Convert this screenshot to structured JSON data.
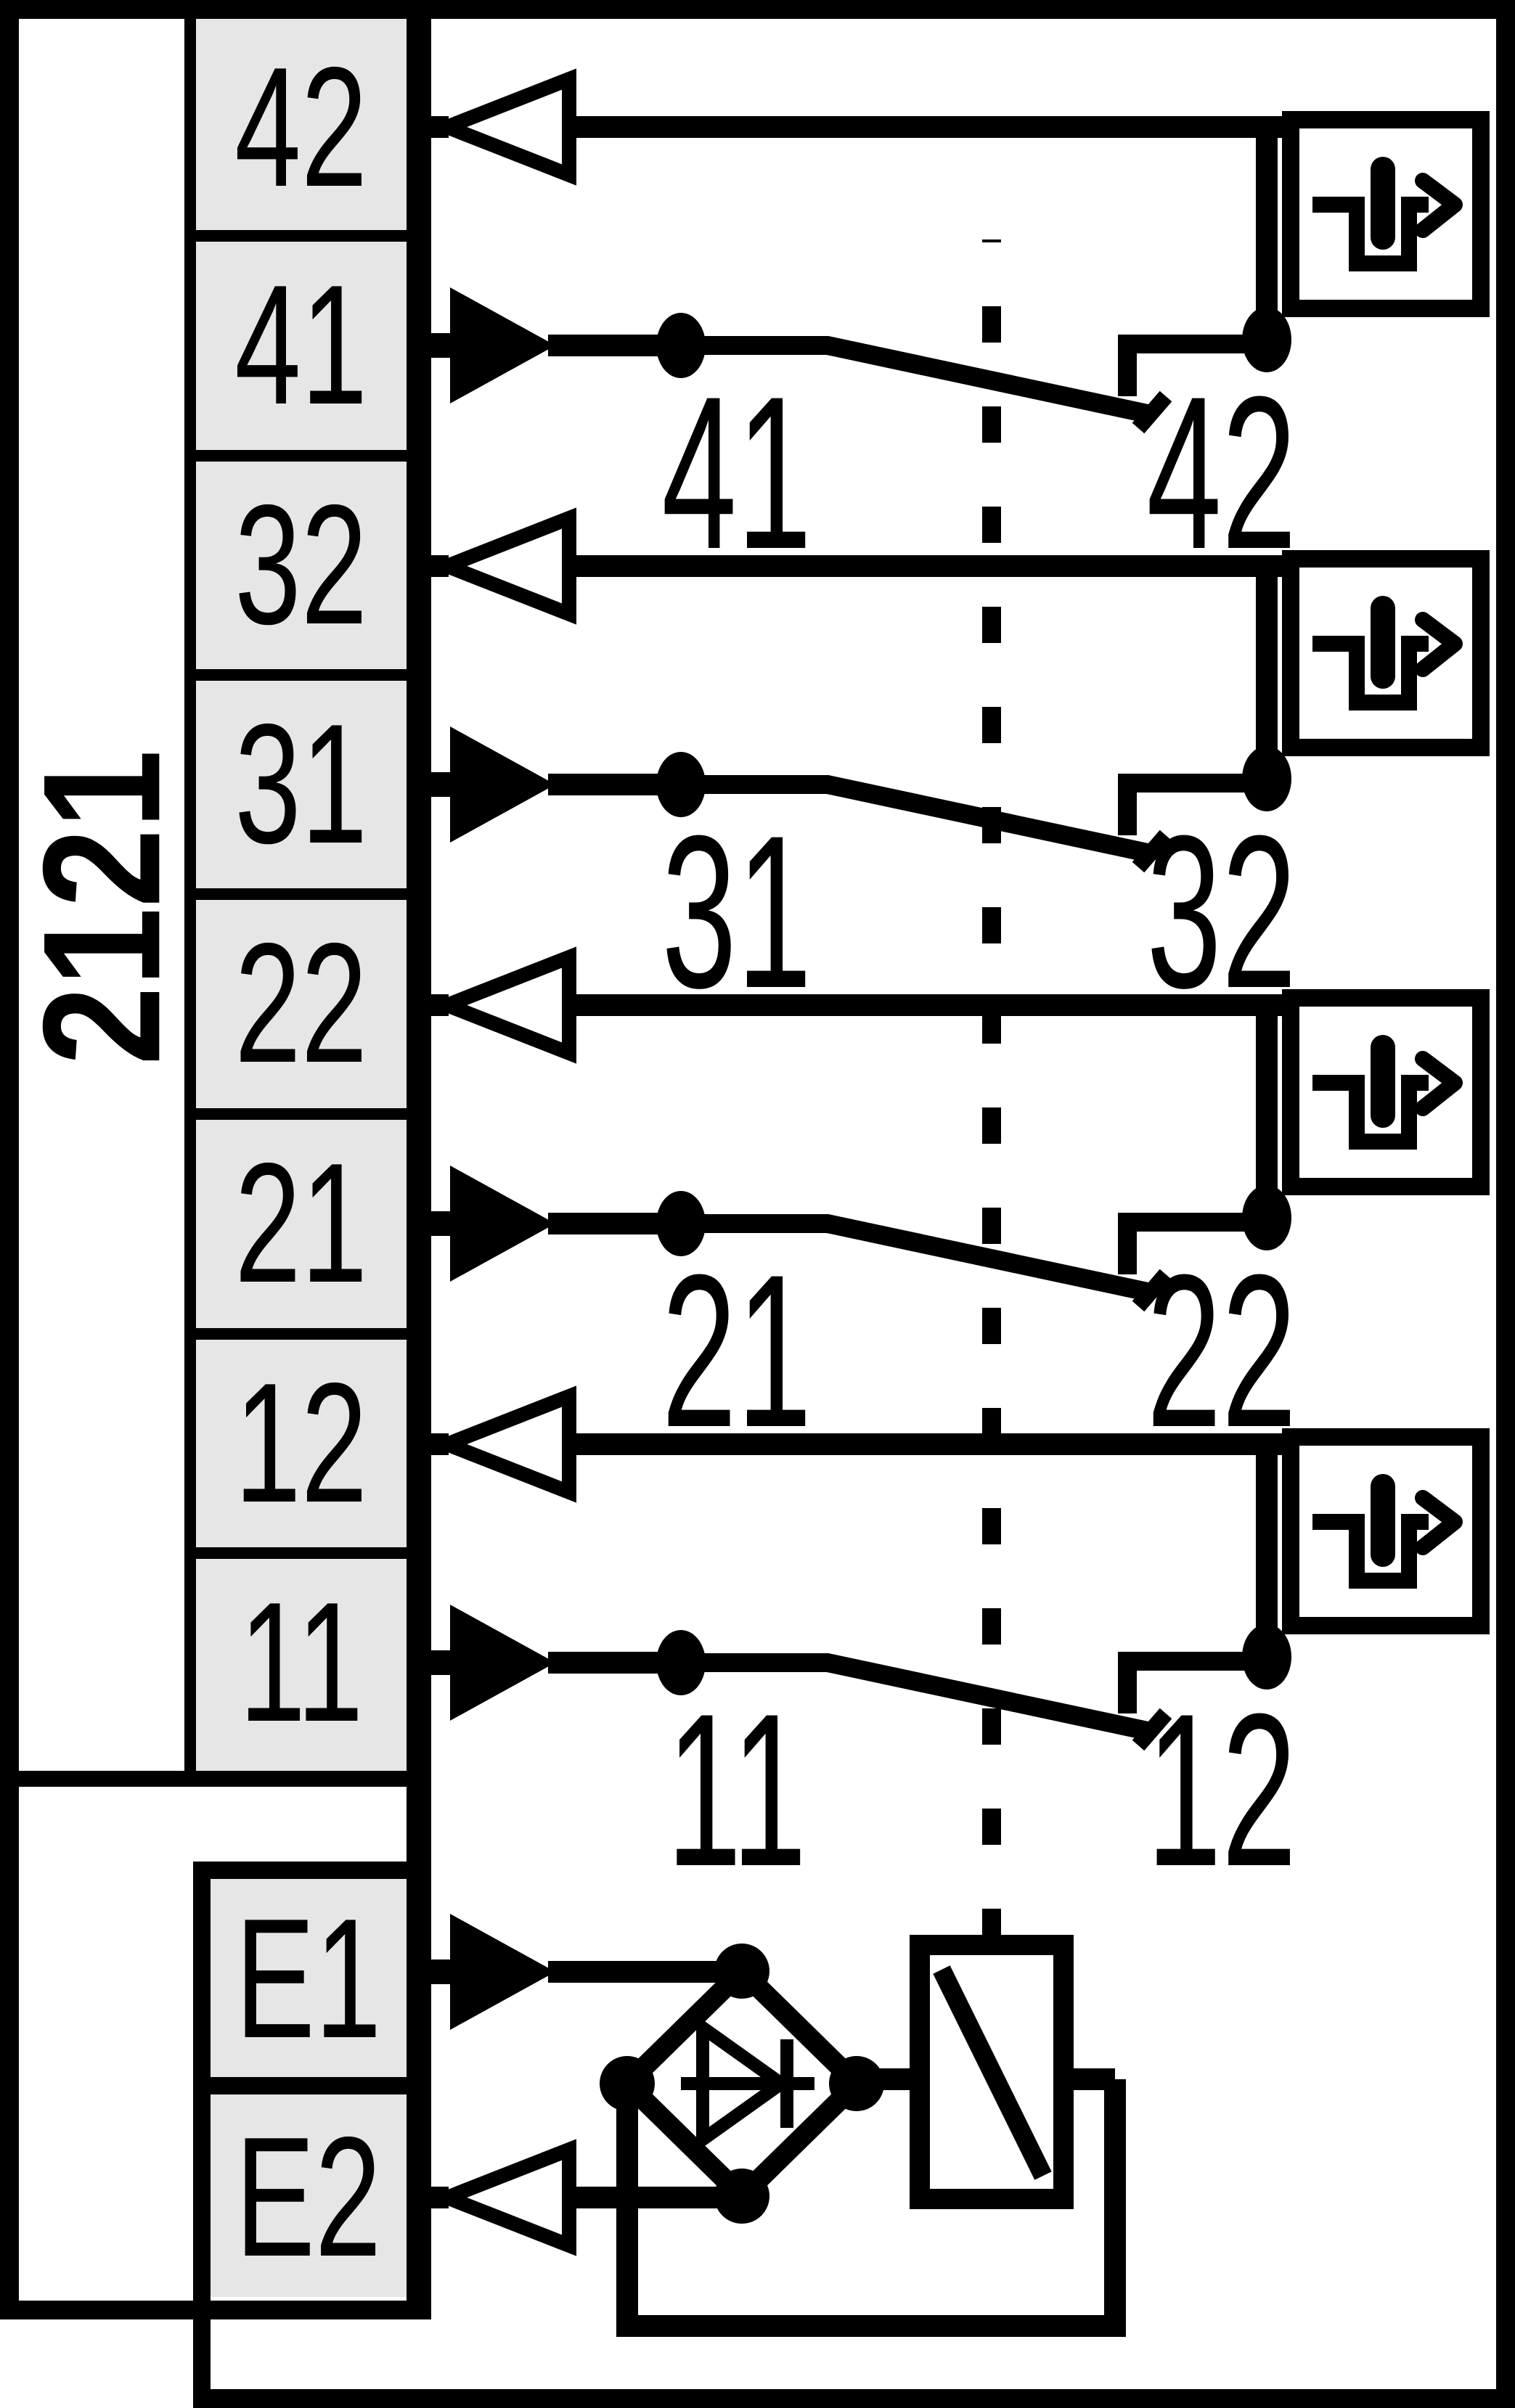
{
  "module": {
    "model_label": "2121"
  },
  "terminal_block": {
    "contact_terminals": [
      "42",
      "41",
      "32",
      "31",
      "22",
      "21",
      "12",
      "11"
    ],
    "coil_terminals": [
      "E1",
      "E2"
    ]
  },
  "contact_groups": [
    {
      "com_label": "41",
      "nc_label": "42"
    },
    {
      "com_label": "31",
      "nc_label": "32"
    },
    {
      "com_label": "21",
      "nc_label": "22"
    },
    {
      "com_label": "11",
      "nc_label": "12"
    }
  ],
  "symbols": {
    "guided_contact_icon": "forced-guided-contact-icon",
    "input_arrow": "input-direction-arrow",
    "output_arrow": "output-direction-arrow",
    "rectifier": "bridge-rectifier-diode",
    "coil": "relay-coil",
    "mechanical_link": "dashed-mechanical-link"
  },
  "colors": {
    "ink": "#000000",
    "background": "#ffffff",
    "terminal_fill": "#e6e6e6"
  }
}
